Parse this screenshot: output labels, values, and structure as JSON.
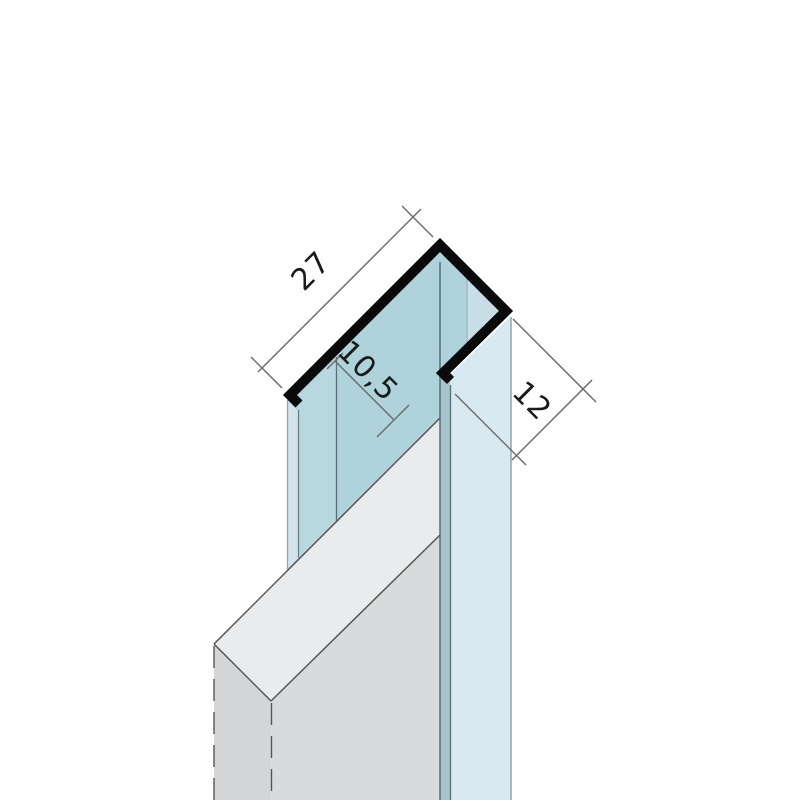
{
  "drawing": {
    "kind": "technical-profile-diagram",
    "view": "isometric",
    "subject": "F-shaped aluminium jointing profile with inserted panel"
  },
  "dimensions": {
    "flange_width": "27",
    "slot_opening": "10,5",
    "leg_depth": "12"
  },
  "colors": {
    "background": "#ffffff",
    "outline": "#0a0a0a",
    "teal_face": "#aed3da",
    "teal_face_light": "#b7d8de",
    "flange_end_strip": "#d3e4ec",
    "inner_diamond": "#c8dee6",
    "leg_end_strip": "#a5c3cb",
    "side_face": "#d9e9f1",
    "panel_top": "#e9ebec",
    "panel_front": "#d8dadb",
    "panel_end": "#d3d5d6",
    "face_edge_dark": "#587076",
    "face_edge_mid": "#6b8086",
    "face_edge_soft": "#93a4aa",
    "face_edge_faint": "#9fb3ba",
    "panel_edge": "#565656",
    "dimension_line": "#6e6e6e",
    "text": "#1a1a1a"
  }
}
